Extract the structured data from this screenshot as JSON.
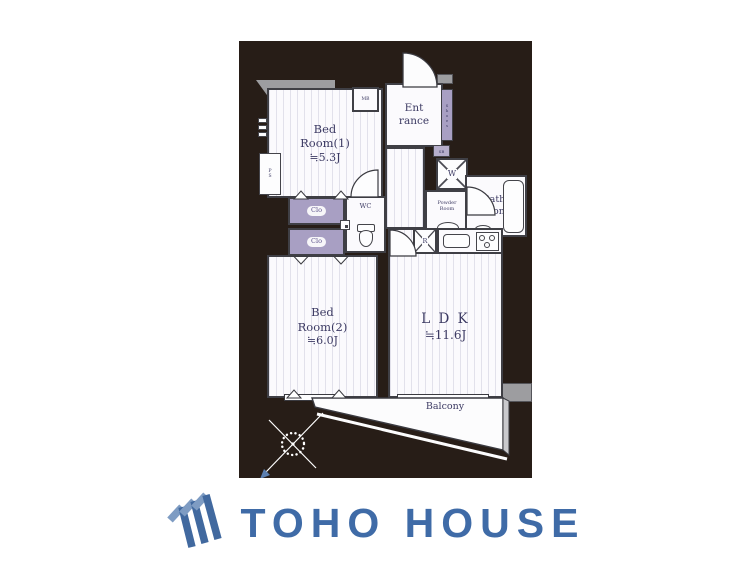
{
  "floorplan": {
    "bedroom1": {
      "l1": "Bed",
      "l2": "Room(1)",
      "size": "≒5.3J"
    },
    "bedroom2": {
      "l1": "Bed",
      "l2": "Room(2)",
      "size": "≒6.0J"
    },
    "ldk": {
      "name": "L D K",
      "size": "≒11.6J"
    },
    "entrance": {
      "l1": "Ent",
      "l2": "rance"
    },
    "bath": {
      "l1": "Bath",
      "l2": "Room"
    },
    "powder": {
      "l1": "Powder",
      "l2": "Room"
    },
    "wc": "WC",
    "mb": "MB",
    "washer": "W",
    "fridge": "R",
    "closet": "Clo",
    "shoes": "Shoes",
    "shoe_box": "SB",
    "pipe_space": "PS",
    "balcony": "Balcony"
  },
  "colors": {
    "plan_background": "#271d17",
    "wall": "#3f3f45",
    "concrete_gray": "#9d9da0",
    "closet_purple": "#a89fc3",
    "label_navy": "#3c3a63",
    "brand_blue": "#3f6ba7"
  },
  "brand": {
    "name": "TOHO HOUSE"
  }
}
